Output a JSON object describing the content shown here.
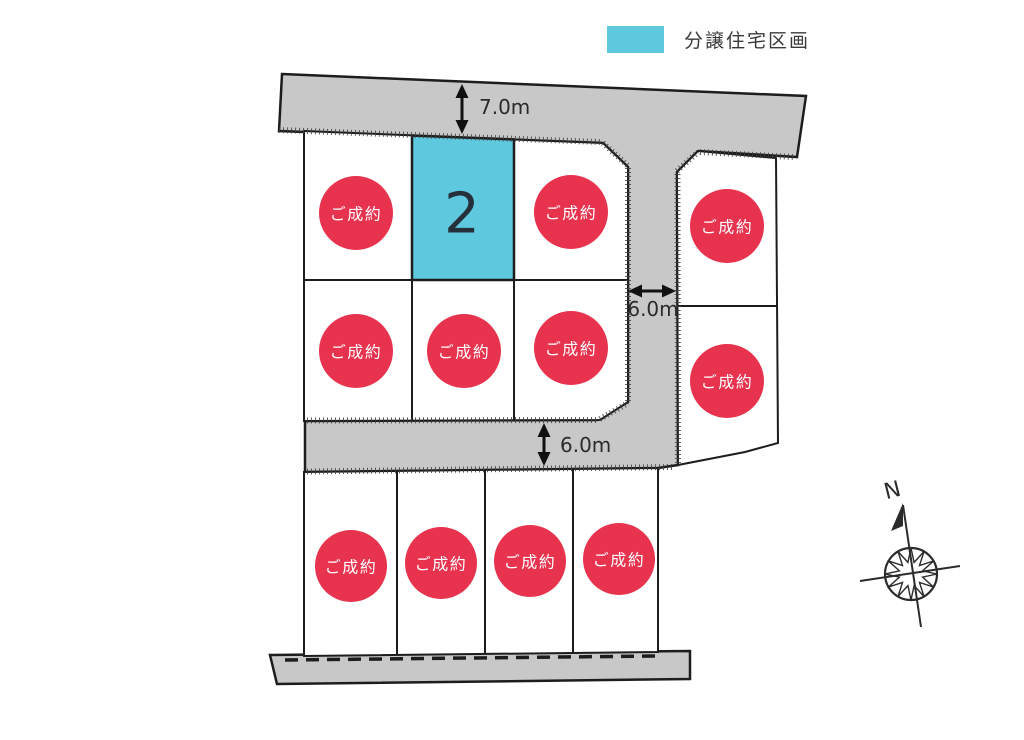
{
  "legend": {
    "label": "分譲住宅区画",
    "swatch_color": "#5EC8DF"
  },
  "colors": {
    "road_fill": "#C8C8C9",
    "lot_fill": "#FFFFFF",
    "outline": "#1D1D1D",
    "sold_badge": "#E8334F",
    "badge_text": "#FFFFFF",
    "available_fill": "#5EC8DF",
    "lot_number_color": "#25303B"
  },
  "dimensions": {
    "top_road": "7.0m",
    "side_road": "6.0m",
    "middle_road": "6.0m"
  },
  "compass": {
    "north_label": "N"
  },
  "available_lot": {
    "number": "2"
  },
  "sold_lots": [
    {
      "id": "upper-block-row1-lot1",
      "status": "ご成約"
    },
    {
      "id": "upper-block-row1-lot3",
      "status": "ご成約"
    },
    {
      "id": "upper-block-row2-lot1",
      "status": "ご成約"
    },
    {
      "id": "upper-block-row2-lot2",
      "status": "ご成約"
    },
    {
      "id": "upper-block-row2-lot3",
      "status": "ご成約"
    },
    {
      "id": "east-block-lot1",
      "status": "ご成約"
    },
    {
      "id": "east-block-lot2",
      "status": "ご成約"
    },
    {
      "id": "south-block-lot1",
      "status": "ご成約"
    },
    {
      "id": "south-block-lot2",
      "status": "ご成約"
    },
    {
      "id": "south-block-lot3",
      "status": "ご成約"
    },
    {
      "id": "south-block-lot4",
      "status": "ご成約"
    }
  ]
}
